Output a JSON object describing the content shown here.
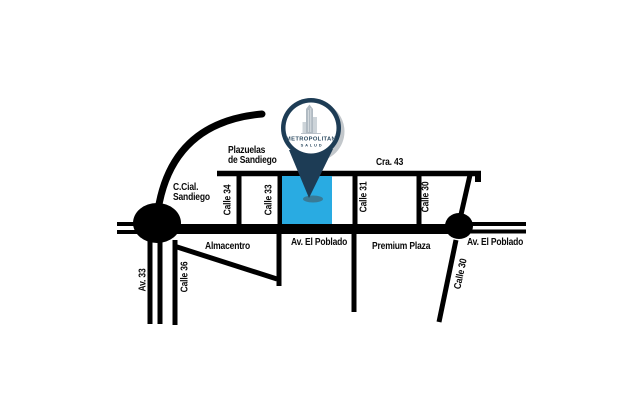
{
  "pin": {
    "brand": "METROPOLITAN",
    "sub": "SALUD"
  },
  "colors": {
    "road": "#000000",
    "highlight_block": "#29abe2",
    "pin_navy": "#1d3c55",
    "logo_text": "#2d4b61"
  },
  "labels": {
    "plazuelas_line1": "Plazuelas",
    "plazuelas_line2": "de Sandiego",
    "cra_43": "Cra. 43",
    "ccial_line1": "C.Cial.",
    "ccial_line2": "Sandiego",
    "calle_34": "Calle 34",
    "calle_33": "Calle 33",
    "calle_31": "Calle 31",
    "calle_30_north": "Calle 30",
    "almacentro": "Almacentro",
    "av_el_poblado_center": "Av. El Poblado",
    "premium_plaza": "Premium Plaza",
    "av_el_poblado_east": "Av. El Poblado",
    "av_33": "Av. 33",
    "calle_36": "Calle 36",
    "calle_30_south": "Calle 30"
  }
}
